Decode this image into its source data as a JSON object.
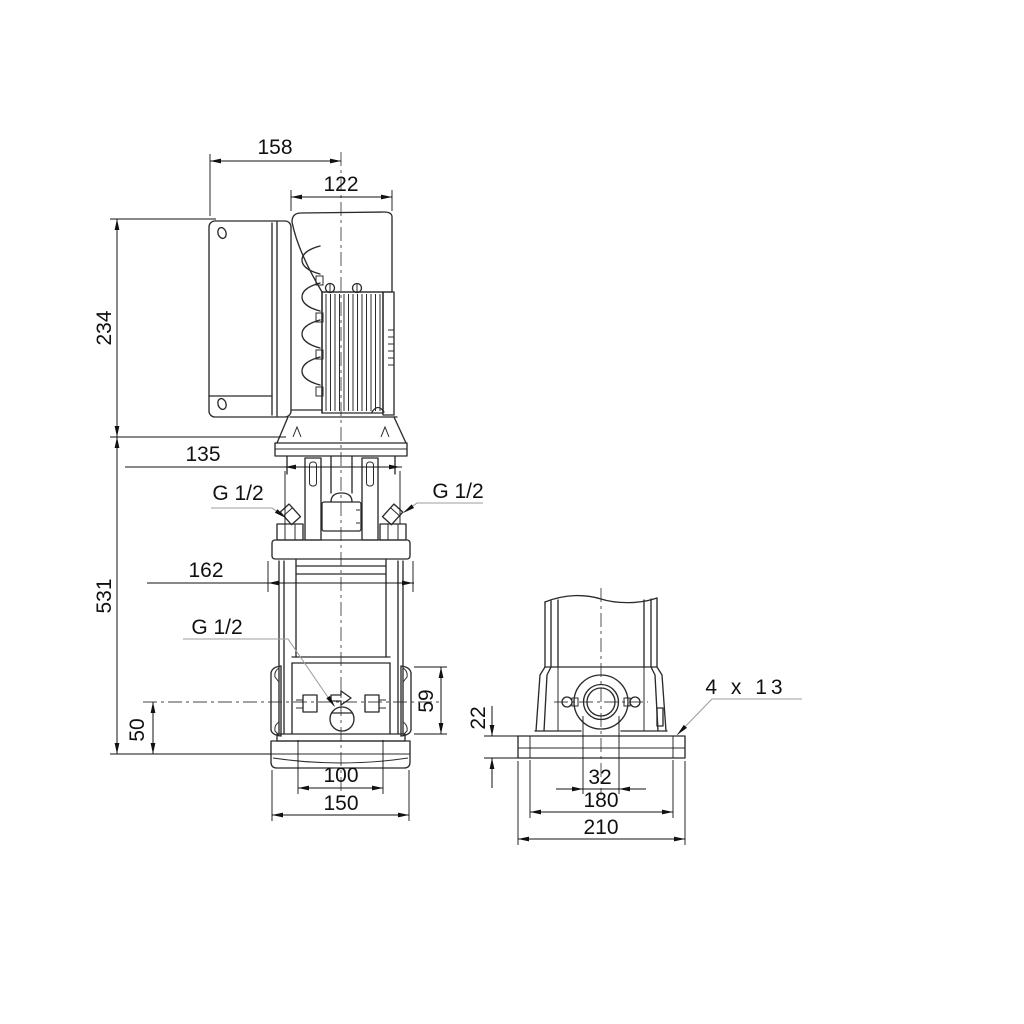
{
  "drawing": {
    "background": "#ffffff",
    "colors": {
      "line": "#2b2b2b",
      "dimension": "#111111",
      "leader": "#9e9e9e",
      "text": "#111111"
    },
    "views": {
      "side_view": "side elevation",
      "front_view": "front elevation"
    },
    "dimensions": {
      "control_box_width": "158",
      "motor_width": "122",
      "motor_height": "234",
      "adapter_width": "135",
      "pump_height": "531",
      "head_flange_width": "162",
      "gauge_port_left": "G 1/2",
      "gauge_port_right": "G 1/2",
      "drain_port": "G 1/2",
      "port_height": "50",
      "port_flange_height": "59",
      "base_bolt_spacing_side": "100",
      "base_width_side": "150",
      "base_plate_height": "22",
      "port_bore": "32",
      "base_bolt_spacing_front": "180",
      "base_width_front": "210",
      "foundation_holes": "4 x 13"
    }
  }
}
